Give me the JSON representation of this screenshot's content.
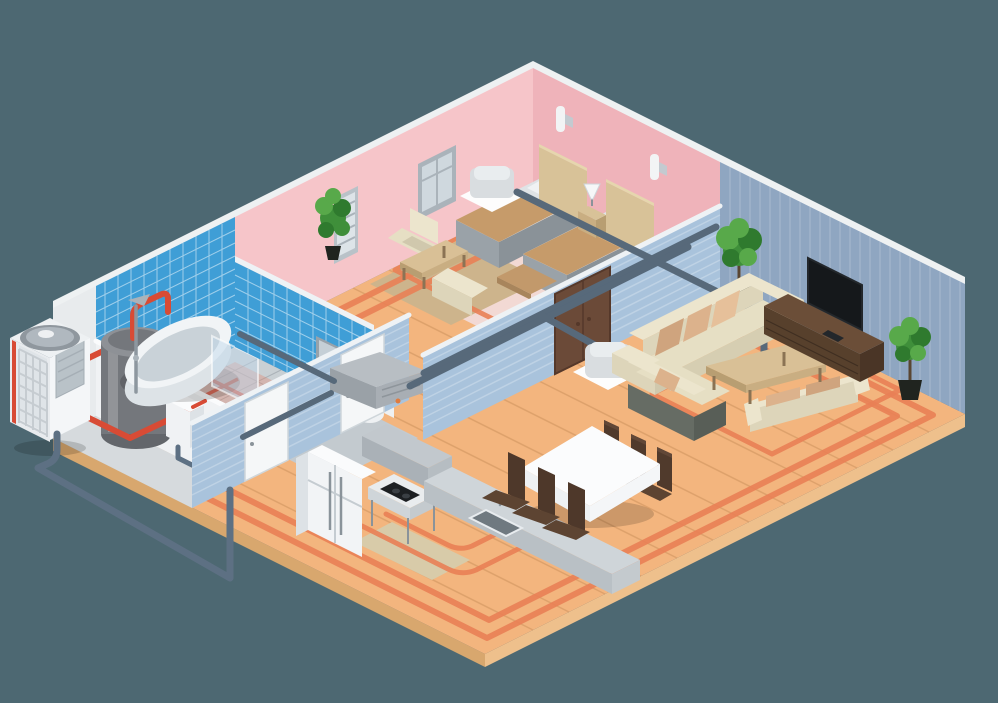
{
  "meta": {
    "title": "Isometric cutaway apartment with heat pump HVAC and underfloor heating",
    "canvas": {
      "width": 998,
      "height": 703
    }
  },
  "scene": {
    "type": "isometric-cutaway-illustration",
    "subject": "Apartment cutaway showing air-source heat pump, hot water tank, ventilation ducts, two ceiling cassette AC units and underfloor heating loops",
    "background": "#4d6872",
    "exterior": {
      "equipment": [
        "outdoor-heat-pump-unit",
        "refrigerant-line"
      ]
    },
    "rooms": [
      {
        "name": "utility-room",
        "wall_finish": "plain gray",
        "items": [
          "hot-water-tank",
          "hydraulic-manifold",
          "red-heating-pipes"
        ]
      },
      {
        "name": "bathroom",
        "wall_finish": "blue ceramic tile",
        "items": [
          "bathtub",
          "shower-fixture",
          "glass-screen",
          "mirror",
          "washbasin",
          "toilet",
          "underfloor-heating-coils"
        ]
      },
      {
        "name": "bedroom",
        "wall_finish": "pink paint",
        "items": [
          "single-bed",
          "single-bed",
          "nightstand",
          "table-lamp",
          "wall-sconce",
          "wall-sconce",
          "window",
          "tall-window",
          "potted-plant",
          "armchair",
          "armchair",
          "coffee-table",
          "bench",
          "ceiling-cassette-ac",
          "pink-rug",
          "tan-rug"
        ]
      },
      {
        "name": "living-room",
        "wall_finish": "blue-gray paneling",
        "items": [
          "three-seat-sofa",
          "loveseat",
          "two-seat-sofa",
          "coffee-table",
          "tv-console",
          "flat-screen-tv",
          "potted-plant",
          "potted-plant",
          "ceiling-cassette-ac"
        ]
      },
      {
        "name": "kitchen-dining",
        "items": [
          "refrigerator",
          "extractor-hood",
          "cooktop-counter",
          "island-counter-with-sink",
          "dining-table-with-tablecloth",
          "dining-chairs-x6",
          "beige-rug"
        ]
      },
      {
        "name": "hallway",
        "items": [
          "ventilation-unit",
          "air-ducts",
          "white-interior-doors",
          "brown-double-door"
        ]
      }
    ],
    "hvac": {
      "outdoor_unit": "air-source heat pump",
      "indoor": "wall-mounted ventilation unit with branch ducts",
      "heating": "underfloor heating loops in every room",
      "cassette_count": 2
    }
  },
  "colors": {
    "bg": "#4d6872",
    "wood": "#f3b57e",
    "woodSideR": "#eec08c",
    "woodSideL": "#d8a76e",
    "plank": "rgba(150,95,45,0.22)",
    "heat": "#e97f55",
    "heatRed": "#d84b35",
    "rugPink": "#f2d9d4",
    "rugTan": "#cdb48c",
    "rugBeige": "#d8cba9",
    "bathFloor": "#c9d0d4",
    "bathGrid": "rgba(100,110,120,0.3)",
    "bathSalmon": "rgba(234,120,88,0.3)",
    "utilFloor": "#d6dadd",
    "corridorFloor": "#c3cacf",
    "trim": "#eef1f2",
    "pinkL": "#f6c5c9",
    "pinkD": "#efb3ba",
    "tile": "#3f9ed6",
    "grout": "rgba(255,255,255,0.5)",
    "grayWall": "#e8ebed",
    "livWall": "#8fa6c1",
    "livStripe": "rgba(255,255,255,0.12)",
    "intWall": "#a9c3dc",
    "intStripe": "rgba(255,255,255,0.25)",
    "cap": "#eef2f5",
    "doorWhite": "#f5f7f8",
    "doorFrame": "#cfd6da",
    "handle": "#8a939a",
    "doorBrown": "#6b4a38",
    "doorBrownD": "#55382a",
    "duct": "#57697a",
    "pipeBlue": "#5d7083",
    "tank": "#74777c",
    "tankTop": "#8e9196",
    "tankBot": "#63666b",
    "tankHi": "rgba(255,255,255,0.22)",
    "boxW": "#f0f2f4",
    "boxWS": "#dde2e6",
    "boxWT": "#fafbfc",
    "unitSW": "#e8ebee",
    "unitSE": "#f4f6f8",
    "unitTop": "#eef1f3",
    "grille": "#dfe4e8",
    "grilleLine": "#c6ccd1",
    "fanO": "#8f979e",
    "fanI": "#b0b8bf",
    "fanHub": "#eef0f2",
    "panel": "#b9c2c8",
    "panelLine": "#a5aeb5",
    "shadow": "rgba(0,0,0,0.16)",
    "chrome": "#8d979f",
    "chromeD": "#aab3ba",
    "tubBody": "#dde3e7",
    "tubRim": "#f1f4f6",
    "tubIn": "#c9d2d8",
    "glass": "rgba(190,215,235,0.45)",
    "glassEdge": "rgba(255,255,255,0.6)",
    "fixW": "#eef1f3",
    "fixS": "#d9e0e4",
    "counter": "#9aa3ab",
    "counterD": "#8f99a1",
    "mirrorF": "#98a2aa",
    "mirrorG": "#c5cfd6",
    "headboard": "#d8c298",
    "headboardT": "#e6d6ae",
    "mattress": "#dfe3e6",
    "pillow": "#f0f2f4",
    "blanket": "#c69b6a",
    "blanketHi": "#d8ae7c",
    "frame": "#9aa2a8",
    "frameD": "#8a9298",
    "bench": "#c2996b",
    "benchD": "#a8855c",
    "lamp": "#f6f7f8",
    "cream": "#ece5cd",
    "creamM": "#e6dfc4",
    "creamD": "#ddd5ba",
    "creamS": "#d0c8ad",
    "seatD": "#d6ceb2",
    "sofaDk": "#666c64",
    "sofaDkS": "#585e57",
    "pilTan1": "#dcb28c",
    "pilTan2": "#e6c09a",
    "pilTan3": "#cfa47e",
    "tableTan": "#d9c096",
    "tableTanD": "#c9ae82",
    "tableTanDD": "#b89e72",
    "leg": "#8b7354",
    "conTop": "#6b4e38",
    "conFront": "#57402c",
    "conSide": "#4a3526",
    "conLine": "#3f2e20",
    "tv": "#15181b",
    "tvStand": "#23272b",
    "g1": "#3f8f3a",
    "g2": "#58a94a",
    "g3": "#2f7a2e",
    "pot": "#20241f",
    "trunk": "#5a4632",
    "chairBackL": "#4e382a",
    "chairBackR": "#503a2c",
    "chairTop": "#614737",
    "chairSeat": "#5d4432",
    "clothTop": "#fbfcfd",
    "clothL": "#eef1f3",
    "clothR": "#f4f6f8",
    "counterTop2": "#cfd5d9",
    "counterFront2": "#b9c0c5",
    "counterEnd2": "#c4cace",
    "sinkIn": "#6f7980",
    "sinkRim": "#e8ecef",
    "cooktop": "#1c1f22",
    "burner": "#3a3f44",
    "applW": "#f2f4f6",
    "applWS": "#dde2e6",
    "applWT": "#fafbfc",
    "applLine": "#c5ccd1",
    "hoodT": "#c2c8cd",
    "hoodF": "#aab1b7",
    "hoodS": "#b6bdc2",
    "cookTopFace": "#e9ecee",
    "casBody": "#d9dde0",
    "casTop": "#e9edef",
    "casPlate": "#fdfdfd",
    "winF": "#aab3ba",
    "winP": "#cfd8de",
    "radF": "#b9c2c8",
    "radP": "#dde4e8",
    "ventT": "#b8bec3",
    "ventL": "#9aa1a7",
    "ventR": "#a8aeb4",
    "ventLine": "#8e959b",
    "ventDot": "#e07b3f",
    "sconce": "#f2f4f5",
    "bracket": "#c3cad0"
  }
}
